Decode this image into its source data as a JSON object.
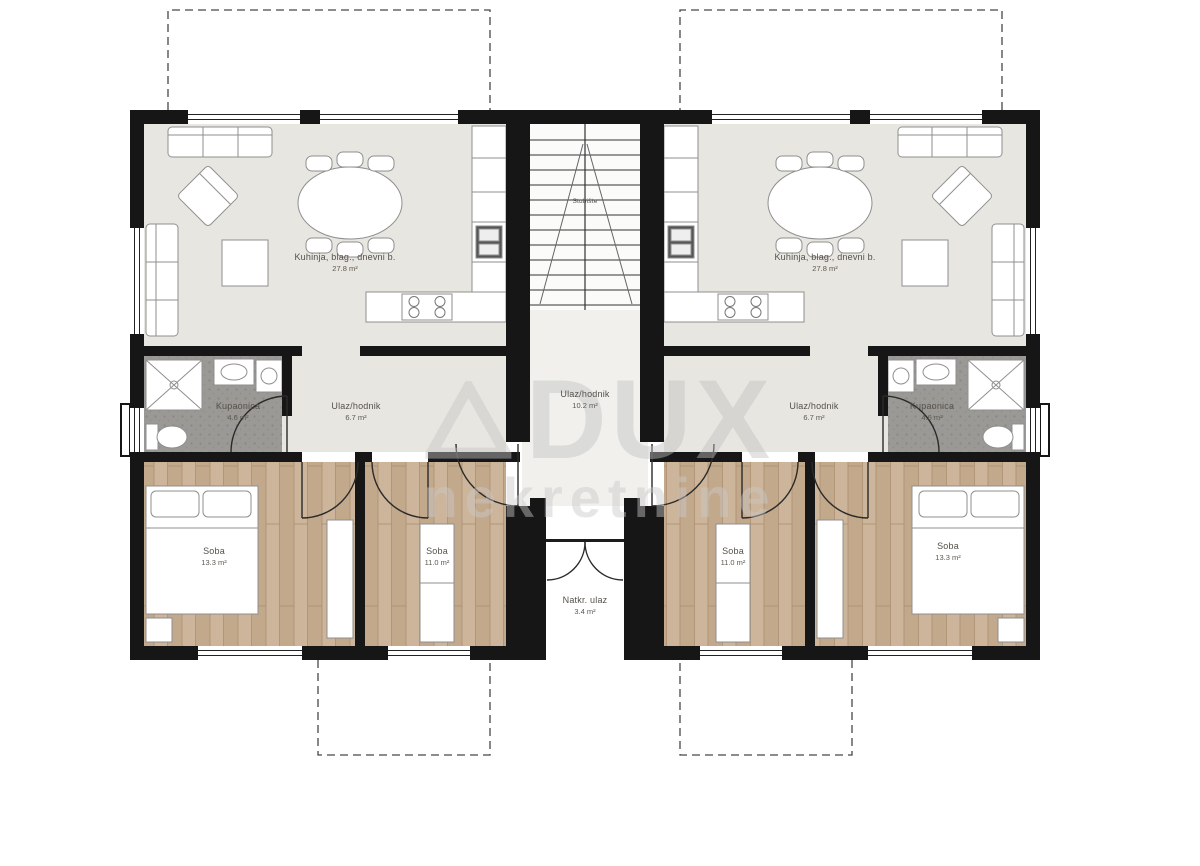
{
  "watermark": {
    "brand": "DUX",
    "subtitle": "nekretnine"
  },
  "palette": {
    "walls": "#161616",
    "living_floor": "#e8e6e1",
    "wood_floor": "#ccb59a",
    "tile_floor": "#9b9995",
    "hall_floor": "#f1f0ed"
  },
  "apartment_left": {
    "living": {
      "name": "Kuhinja, blag., dnevni b.",
      "area": "27.8 m²"
    },
    "hall": {
      "name": "Ulaz/hodnik",
      "area": "6.7 m²"
    },
    "bathroom": {
      "name": "Kupaonica",
      "area": "4.6 m²"
    },
    "bedroom_large": {
      "name": "Soba",
      "area": "13.3 m²"
    },
    "bedroom_small": {
      "name": "Soba",
      "area": "11.0 m²"
    }
  },
  "apartment_right": {
    "living": {
      "name": "Kuhinja, blag., dnevni b.",
      "area": "27.8 m²"
    },
    "hall": {
      "name": "Ulaz/hodnik",
      "area": "6.7 m²"
    },
    "bathroom": {
      "name": "Kupaonica",
      "area": "4.6 m²"
    },
    "bedroom_large": {
      "name": "Soba",
      "area": "13.3 m²"
    },
    "bedroom_small": {
      "name": "Soba",
      "area": "11.0 m²"
    }
  },
  "common": {
    "staircase": {
      "name": "Stubište"
    },
    "entry_hall": {
      "name": "Ulaz/hodnik",
      "area": "10.2 m²"
    },
    "covered_entrance": {
      "name": "Natkr. ulaz",
      "area": "3.4 m²"
    }
  }
}
